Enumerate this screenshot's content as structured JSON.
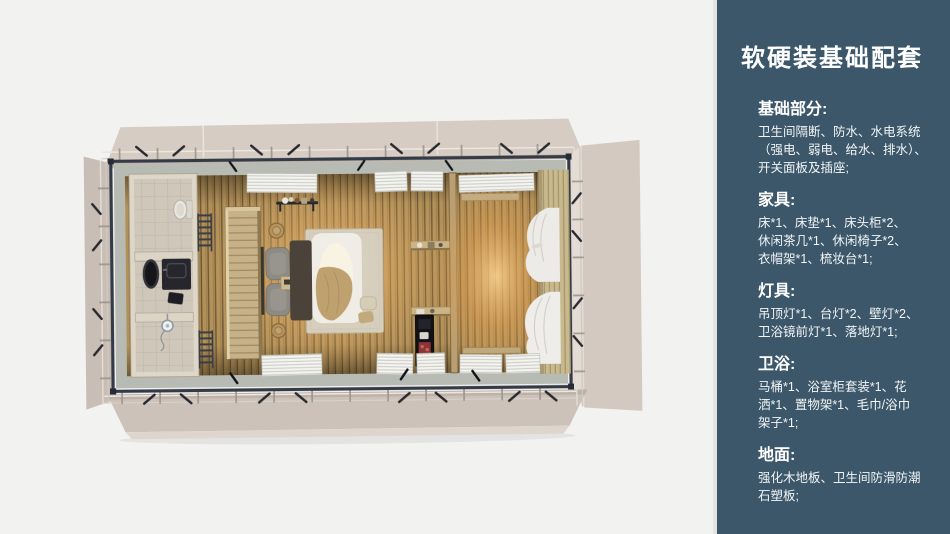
{
  "page": {
    "background_color": "#f2f2f0"
  },
  "plan": {
    "colors": {
      "flap_panel": "#d5cbc3",
      "steel_frame": "#343b47",
      "wood_floor": "#b29159",
      "warm_glow": "#f0b264",
      "bathroom_floor": "#cfc8ba",
      "bed_duvet": "#f0ede6",
      "curtain": "#edebe7"
    }
  },
  "sidebar": {
    "background_color": "#3b5769",
    "text_color": "#ffffff",
    "title": "软硬装基础配套",
    "sections": [
      {
        "heading": "基础部分:",
        "body": "卫生间隔断、防水、水电系统\n（强电、弱电、给水、排水）、\n开关面板及插座;"
      },
      {
        "heading": "家具:",
        "body": "床*1、床垫*1、床头柜*2、\n休闲茶几*1、休闲椅子*2、\n衣帽架*1、梳妆台*1;"
      },
      {
        "heading": "灯具:",
        "body": "吊顶灯*1、台灯*2、壁灯*2、\n卫浴镜前灯*1、落地灯*1;"
      },
      {
        "heading": "卫浴:",
        "body": "马桶*1、浴室柜套装*1、花\n洒*1、置物架*1、毛巾/浴巾\n架子*1;"
      },
      {
        "heading": "地面:",
        "body": "强化木地板、卫生间防滑防潮\n石塑板;"
      }
    ]
  }
}
